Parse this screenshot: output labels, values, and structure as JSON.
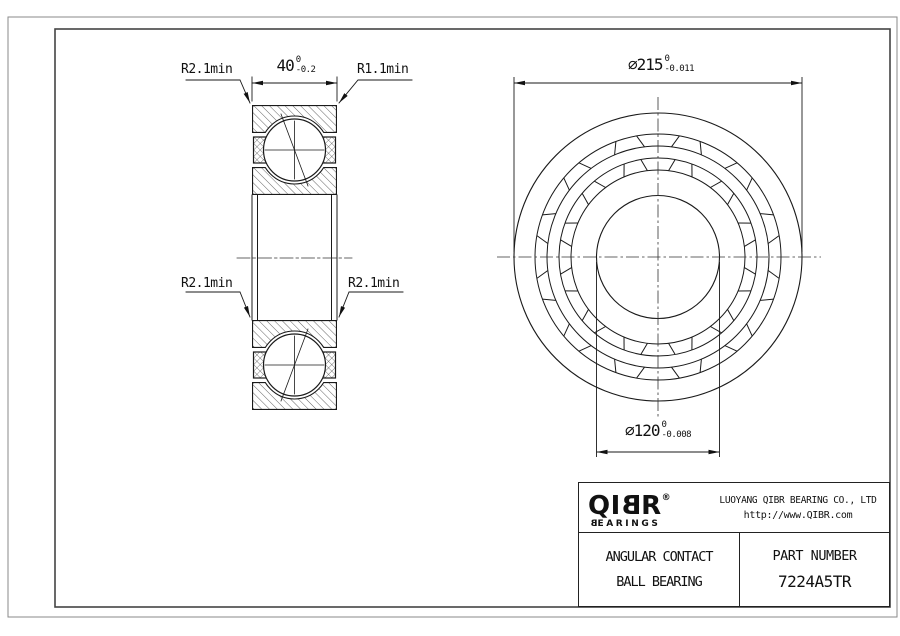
{
  "drawing": {
    "dimensions": {
      "width": {
        "value": "40",
        "tol_upper": "0",
        "tol_lower": "-0.2"
      },
      "outer_diameter": {
        "symbol": "⌀",
        "value": "215",
        "tol_upper": "0",
        "tol_lower": "-0.011"
      },
      "bore_diameter": {
        "symbol": "⌀",
        "value": "120",
        "tol_upper": "0",
        "tol_lower": "-0.008"
      },
      "radius_top_left": "R2.1min",
      "radius_top_right": "R1.1min",
      "radius_bottom_left": "R2.1min",
      "radius_bottom_right": "R2.1min"
    },
    "views": [
      "cross-section",
      "front"
    ]
  },
  "title_block": {
    "logo": {
      "part1": "QI",
      "part2": "B",
      "part3": "R",
      "registered": "®",
      "sub_b": "B",
      "sub_rest": "EARINGS"
    },
    "company_name": "LUOYANG QIBR BEARING CO., LTD",
    "website": "http://www.QIBR.com",
    "product_line1": "ANGULAR CONTACT",
    "product_line2": "BALL BEARING",
    "part_number_label": "PART NUMBER",
    "part_number": "7224A5TR"
  },
  "colors": {
    "line": "#1a1a1a",
    "frame_outer": "#8a8a8a",
    "frame_inner": "#444444",
    "background": "#ffffff"
  }
}
